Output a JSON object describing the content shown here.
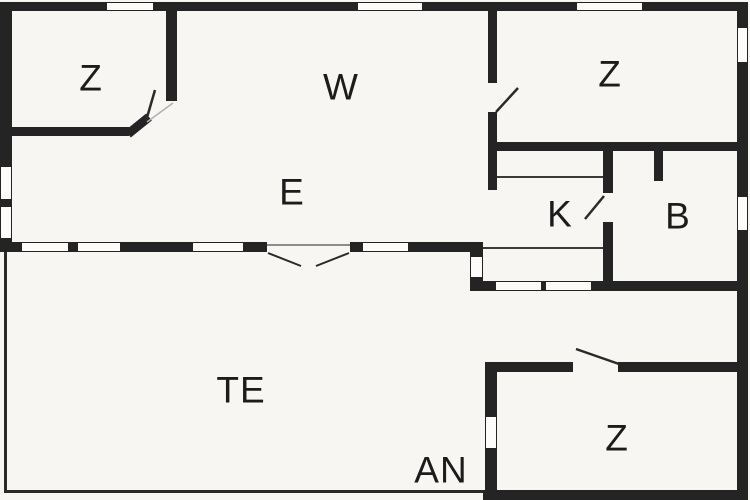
{
  "floor_plan": {
    "type": "house-floor-plan",
    "rooms": [
      {
        "id": "z1",
        "label": "Z"
      },
      {
        "id": "w",
        "label": "W"
      },
      {
        "id": "z2",
        "label": "Z"
      },
      {
        "id": "e",
        "label": "E"
      },
      {
        "id": "k",
        "label": "K"
      },
      {
        "id": "b",
        "label": "B"
      },
      {
        "id": "te",
        "label": "TE"
      },
      {
        "id": "an",
        "label": "AN"
      },
      {
        "id": "z3",
        "label": "Z"
      }
    ],
    "colors": {
      "wall": "#242424",
      "background": "#f8f6f3",
      "window_fill": "#fdfcfa",
      "label_text": "#1c1c1c"
    }
  }
}
